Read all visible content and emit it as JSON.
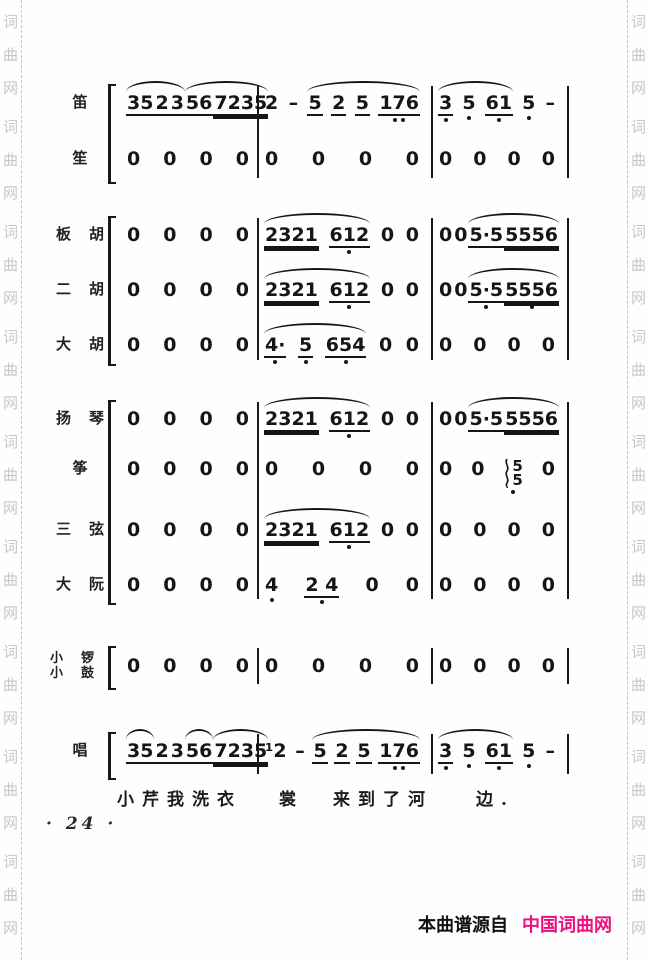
{
  "watermark": {
    "text": "词曲网",
    "color": "#c7c7c7",
    "repeats": 9
  },
  "footer": {
    "prefix": "本曲谱源自",
    "site": "中国词曲网",
    "site_color": "#ed0f7e"
  },
  "page_number": "· 24 ·",
  "lyrics": [
    {
      "text": "小芹我洗衣",
      "x": 117
    },
    {
      "text": "裳",
      "x": 279
    },
    {
      "text": "来到了河",
      "x": 333
    },
    {
      "text": "边.",
      "x": 476
    }
  ],
  "layout": {
    "measure_boxes": [
      {
        "x": 124,
        "w": 132
      },
      {
        "x": 262,
        "w": 164
      },
      {
        "x": 436,
        "w": 126
      }
    ],
    "barline_xs": [
      257,
      431,
      567
    ],
    "bracket_x": 108,
    "lyrics_y": 785,
    "wm_left_x": 2,
    "wm_right_x": 630,
    "dash_left_x": 21,
    "dash_right_x": 627
  },
  "score": {
    "groups": [
      {
        "top": 84,
        "bottom": 180,
        "rows": [
          {
            "label": "笛",
            "y": 92,
            "measures": [
              {
                "tokens": [
                  "35",
                  "2",
                  "3",
                  "56",
                  "7235"
                ],
                "ul": [
                  1,
                  2
                ],
                "slurs": [
                  [
                    0,
                    2
                  ],
                  [
                    3,
                    4
                  ]
                ]
              },
              {
                "tokens": [
                  "2",
                  "–",
                  "5",
                  "2",
                  "5",
                  "176"
                ],
                "ul": [
                  2,
                  3,
                  4
                ],
                "slurs": [
                  [
                    2,
                    5
                  ]
                ],
                "dots": [
                  5,
                  5
                ]
              },
              {
                "tokens": [
                  "3",
                  "5",
                  "61",
                  "5",
                  "–"
                ],
                "ul": [
                  0
                ],
                "slurs": [
                  [
                    0,
                    2
                  ]
                ],
                "dots": [
                  0,
                  1,
                  2,
                  3
                ]
              }
            ]
          },
          {
            "label": "笙",
            "y": 148,
            "measures": [
              {
                "tokens": [
                  "0",
                  "0",
                  "0",
                  "0"
                ]
              },
              {
                "tokens": [
                  "0",
                  "0",
                  "0",
                  "0"
                ]
              },
              {
                "tokens": [
                  "0",
                  "0",
                  "0",
                  "0"
                ]
              }
            ]
          }
        ]
      },
      {
        "top": 216,
        "bottom": 362,
        "rows": [
          {
            "label": "板胡",
            "y": 224,
            "measures": [
              {
                "tokens": [
                  "0",
                  "0",
                  "0",
                  "0"
                ]
              },
              {
                "tokens": [
                  "2321",
                  "612",
                  "0",
                  "0"
                ],
                "slurs": [
                  [
                    0,
                    1
                  ]
                ],
                "dots": [
                  1
                ]
              },
              {
                "tokens": [
                  "0",
                  "0",
                  "5·5",
                  "5556"
                ],
                "slurs": [
                  [
                    2,
                    3
                  ]
                ]
              }
            ]
          },
          {
            "label": "二胡",
            "y": 279,
            "measures": [
              {
                "tokens": [
                  "0",
                  "0",
                  "0",
                  "0"
                ]
              },
              {
                "tokens": [
                  "2321",
                  "612",
                  "0",
                  "0"
                ],
                "slurs": [
                  [
                    0,
                    1
                  ]
                ],
                "dots": [
                  1
                ]
              },
              {
                "tokens": [
                  "0",
                  "0",
                  "5·5",
                  "5556"
                ],
                "slurs": [
                  [
                    2,
                    3
                  ]
                ],
                "dots": [
                  2,
                  3
                ]
              }
            ]
          },
          {
            "label": "大胡",
            "y": 334,
            "measures": [
              {
                "tokens": [
                  "0",
                  "0",
                  "0",
                  "0"
                ]
              },
              {
                "tokens": [
                  "4·",
                  "5",
                  "654",
                  "0",
                  "0"
                ],
                "ul": [
                  0,
                  1
                ],
                "slurs": [
                  [
                    0,
                    2
                  ]
                ],
                "dots": [
                  0,
                  1,
                  2
                ]
              },
              {
                "tokens": [
                  "0",
                  "0",
                  "0",
                  "0"
                ]
              }
            ]
          }
        ]
      },
      {
        "top": 400,
        "bottom": 601,
        "rows": [
          {
            "label": "扬琴",
            "y": 408,
            "measures": [
              {
                "tokens": [
                  "0",
                  "0",
                  "0",
                  "0"
                ]
              },
              {
                "tokens": [
                  "2321",
                  "612",
                  "0",
                  "0"
                ],
                "slurs": [
                  [
                    0,
                    1
                  ]
                ],
                "dots": [
                  1
                ]
              },
              {
                "tokens": [
                  "0",
                  "0",
                  "5·5",
                  "5556"
                ],
                "slurs": [
                  [
                    2,
                    3
                  ]
                ]
              }
            ]
          },
          {
            "label": "筝",
            "y": 458,
            "measures": [
              {
                "tokens": [
                  "0",
                  "0",
                  "0",
                  "0"
                ]
              },
              {
                "tokens": [
                  "0",
                  "0",
                  "0",
                  "0"
                ]
              },
              {
                "tokens": [
                  "0",
                  "0",
                  {
                    "stack": [
                      "5",
                      "5"
                    ]
                  },
                  "0"
                ],
                "dots": [
                  2
                ]
              }
            ]
          },
          {
            "label": "三弦",
            "y": 519,
            "measures": [
              {
                "tokens": [
                  "0",
                  "0",
                  "0",
                  "0"
                ]
              },
              {
                "tokens": [
                  "2321",
                  "612",
                  "0",
                  "0"
                ],
                "slurs": [
                  [
                    0,
                    1
                  ]
                ],
                "dots": [
                  1
                ]
              },
              {
                "tokens": [
                  "0",
                  "0",
                  "0",
                  "0"
                ]
              }
            ]
          },
          {
            "label": "大阮",
            "y": 574,
            "measures": [
              {
                "tokens": [
                  "0",
                  "0",
                  "0",
                  "0"
                ]
              },
              {
                "tokens": [
                  "4",
                  "2 4",
                  "0",
                  "0"
                ],
                "dots": [
                  0,
                  1
                ]
              },
              {
                "tokens": [
                  "0",
                  "0",
                  "0",
                  "0"
                ]
              }
            ]
          }
        ]
      },
      {
        "top": 646,
        "bottom": 686,
        "rows": [
          {
            "label": [
              "小锣",
              "小鼓"
            ],
            "y": 655,
            "measures": [
              {
                "tokens": [
                  "0",
                  "0",
                  "0",
                  "0"
                ]
              },
              {
                "tokens": [
                  "0",
                  "0",
                  "0",
                  "0"
                ]
              },
              {
                "tokens": [
                  "0",
                  "0",
                  "0",
                  "0"
                ]
              }
            ]
          }
        ]
      },
      {
        "top": 732,
        "bottom": 776,
        "rows": [
          {
            "label": "唱",
            "y": 740,
            "measures": [
              {
                "tokens": [
                  "35",
                  "2",
                  "3",
                  "56",
                  "7235"
                ],
                "ul": [
                  1,
                  2
                ],
                "slurs": [
                  [
                    0,
                    0
                  ],
                  [
                    3,
                    3
                  ],
                  [
                    4,
                    4
                  ]
                ]
              },
              {
                "tokens": [
                  "¹2",
                  "–",
                  "5",
                  "2",
                  "5",
                  "176"
                ],
                "ul": [
                  2,
                  3,
                  4
                ],
                "slurs": [
                  [
                    2,
                    5
                  ]
                ],
                "dots": [
                  5,
                  5
                ]
              },
              {
                "tokens": [
                  "3",
                  "5",
                  "61",
                  "5",
                  "–"
                ],
                "ul": [
                  0
                ],
                "slurs": [
                  [
                    0,
                    2
                  ]
                ],
                "dots": [
                  0,
                  1,
                  2,
                  3
                ]
              }
            ]
          }
        ]
      }
    ]
  }
}
